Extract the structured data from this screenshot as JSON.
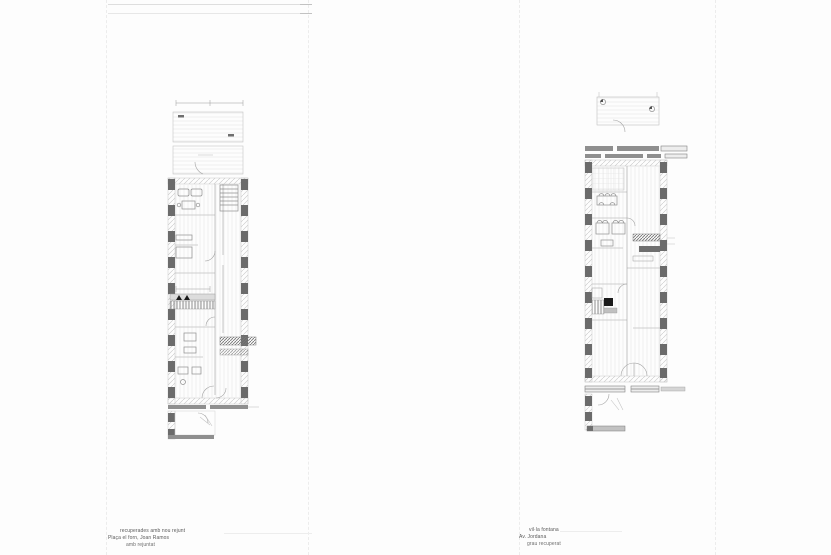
{
  "palette": {
    "ink": "#4a4a4a",
    "line": "#a3a3a3",
    "pilaster": "#6b6b6b",
    "slab": "#8f8f8f",
    "fold": "#ececec",
    "wall": "#c6c6c6",
    "dark": "#777777",
    "accent": "#1a1a1a"
  },
  "captions": {
    "left": {
      "line1": "recuperades amb nou rejunt",
      "line2": "Plaça el forn, Joan Ramos",
      "line3": "amb rejuntat"
    },
    "right": {
      "line1": "vil·la fontana",
      "line2": "Av. Jordana",
      "line3": "grau recuperat"
    }
  }
}
